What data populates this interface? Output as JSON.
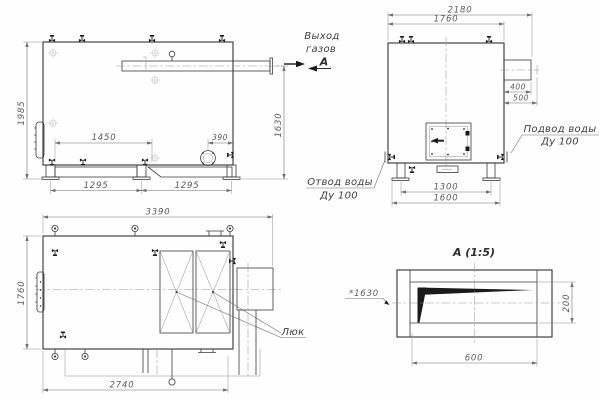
{
  "drawing_title": "Boiler general-arrangement drawing",
  "colors": {
    "outline": "#3b3b3b",
    "dim_lines": "#6f6f6f",
    "dim_text": "#5a5a5a",
    "background": "#fefefe",
    "fill_black": "#1a1a1a"
  },
  "side_view": {
    "dim_height_overall": "1985",
    "dim_height_flue": "1630",
    "dim_span_top": "1450",
    "dim_flange_offset": "390",
    "dim_base_left": "1295",
    "dim_base_right": "1295",
    "label_gas_outlet_1": "Выход",
    "label_gas_outlet_2": "газов",
    "section_mark": "А"
  },
  "front_view": {
    "dim_width_overall": "2180",
    "dim_width_body": "1760",
    "dim_duct_length": "400",
    "dim_duct_overall": "500",
    "dim_base_inner": "1300",
    "dim_base_outer": "1600",
    "label_water_inlet": "Подвод воды",
    "label_water_inlet_dn": "Ду 100",
    "label_water_outlet": "Отвод воды",
    "label_water_outlet_dn": "Ду 100"
  },
  "plan_view": {
    "dim_length_overall": "3390",
    "dim_width": "1760",
    "dim_base_length": "2740",
    "label_hatch": "Люк"
  },
  "section_view": {
    "title": "А  (1:5)",
    "dim_width": "600",
    "dim_height": "200",
    "dim_elevation": "*1630"
  }
}
